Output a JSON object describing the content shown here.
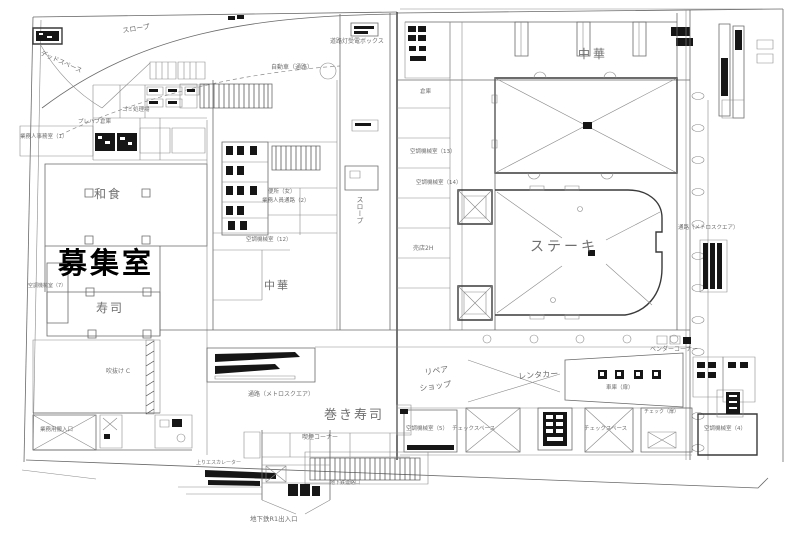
{
  "page": {
    "title": "建物平面図（1階フロアプラン）",
    "background": "#ffffff"
  },
  "colors": {
    "wall": "#5a5a5a",
    "wall_dark": "#1a1a1a",
    "label_text": "#6f6f6f",
    "highlight_text": "#000000"
  },
  "highlight": {
    "room": "募集室"
  },
  "labels": [
    {
      "name": "slope-top-label",
      "text": "スロープ",
      "x": 122,
      "y": 28,
      "size": 7,
      "rot": -9
    },
    {
      "name": "dead-space-label",
      "text": "デッドスペース",
      "x": 42,
      "y": 50,
      "size": 6.5,
      "rot": 24
    },
    {
      "name": "car-corridor-label",
      "text": "自動車（通路）",
      "x": 271,
      "y": 65,
      "size": 6
    },
    {
      "name": "street-light-box-label",
      "text": "道路灯受電ボックス",
      "x": 330,
      "y": 39,
      "size": 6
    },
    {
      "name": "chuka-top-label",
      "text": "中華",
      "x": 578,
      "y": 48,
      "size": 12,
      "ls": 3
    },
    {
      "name": "washoku-label",
      "text": "和食",
      "x": 94,
      "y": 188,
      "size": 12,
      "ls": 2
    },
    {
      "name": "boshushitsu-label",
      "text": "募集室",
      "x": 58,
      "y": 249,
      "size": 29,
      "ls": 3,
      "sharp": true
    },
    {
      "name": "sushi-label",
      "text": "寿司",
      "x": 96,
      "y": 302,
      "size": 12,
      "ls": 2
    },
    {
      "name": "chuka-center-label",
      "text": "中華",
      "x": 264,
      "y": 280,
      "size": 11,
      "ls": 2
    },
    {
      "name": "slope-center-label",
      "text": "スロープ",
      "x": 356,
      "y": 196,
      "size": 7,
      "vert": true
    },
    {
      "name": "steak-label",
      "text": "ステーキ",
      "x": 530,
      "y": 240,
      "size": 14,
      "ls": 3
    },
    {
      "name": "baiten-2h-label",
      "text": "売店2H",
      "x": 413,
      "y": 246,
      "size": 6
    },
    {
      "name": "tsuro-right-label",
      "text": "通路（メトロスクエア）",
      "x": 678,
      "y": 226,
      "size": 5.5
    },
    {
      "name": "tsuro-bottom-label",
      "text": "通路（メトロスクエア）",
      "x": 248,
      "y": 392,
      "size": 6
    },
    {
      "name": "makizushi-label",
      "text": "巻き寿司",
      "x": 324,
      "y": 409,
      "size": 13,
      "ls": 2
    },
    {
      "name": "repair-shop-label-1",
      "text": "リペア",
      "x": 424,
      "y": 369,
      "size": 8,
      "rot": -8
    },
    {
      "name": "repair-shop-label-2",
      "text": "ショップ",
      "x": 419,
      "y": 385,
      "size": 8,
      "rot": -8
    },
    {
      "name": "rentacar-label",
      "text": "レンタカー",
      "x": 518,
      "y": 373,
      "size": 8,
      "rot": -4
    },
    {
      "name": "vendor-corner-label",
      "text": "ベンダーコーナー",
      "x": 650,
      "y": 347,
      "size": 6
    },
    {
      "name": "ac-room-5-label",
      "text": "空調機械室（5）",
      "x": 406,
      "y": 427,
      "size": 5.5
    },
    {
      "name": "check-space-1-label",
      "text": "チェックスペース",
      "x": 452,
      "y": 427,
      "size": 5.5
    },
    {
      "name": "check-space-2-label",
      "text": "チェックスペース",
      "x": 584,
      "y": 427,
      "size": 5.5
    },
    {
      "name": "check-door-label",
      "text": "チェック（扉）",
      "x": 644,
      "y": 410,
      "size": 5
    },
    {
      "name": "ac-room-4-label",
      "text": "空調機械室（4）",
      "x": 704,
      "y": 427,
      "size": 5.5
    },
    {
      "name": "subway-entrance-label",
      "text": "地下鉄R1出入口",
      "x": 250,
      "y": 516,
      "size": 6.5
    },
    {
      "name": "smoking-corner-label",
      "text": "喫煙コーナー",
      "x": 302,
      "y": 435,
      "size": 6
    },
    {
      "name": "toilet-women-label",
      "text": "便所（女）",
      "x": 268,
      "y": 190,
      "size": 5.5
    },
    {
      "name": "staff-corridor-2-label",
      "text": "業務人員通路（2）",
      "x": 262,
      "y": 199,
      "size": 5.5
    },
    {
      "name": "ac-room-12-label",
      "text": "空調機械室（12）",
      "x": 246,
      "y": 238,
      "size": 5.5
    },
    {
      "name": "ac-room-13-label",
      "text": "空調機械室（13）",
      "x": 410,
      "y": 150,
      "size": 5.5
    },
    {
      "name": "ac-room-14-label",
      "text": "空調機械室（14）",
      "x": 416,
      "y": 181,
      "size": 5.5
    },
    {
      "name": "ac-room-7-label",
      "text": "空調機械室（7）",
      "x": 28,
      "y": 284,
      "size": 5
    },
    {
      "name": "gomi-label",
      "text": "ゴミ処理場",
      "x": 122,
      "y": 108,
      "size": 5.5
    },
    {
      "name": "prefab-label",
      "text": "プレハブ倉庫",
      "x": 78,
      "y": 120,
      "size": 5.5
    },
    {
      "name": "staff-office-1-label",
      "text": "業務人事務室（1）",
      "x": 20,
      "y": 135,
      "size": 5.5
    },
    {
      "name": "souko-label",
      "text": "倉庫",
      "x": 420,
      "y": 90,
      "size": 5.5
    },
    {
      "name": "shako-door-label",
      "text": "車庫（扉）",
      "x": 606,
      "y": 386,
      "size": 5.5
    },
    {
      "name": "up-escalator-label",
      "text": "上りエスカレーター",
      "x": 196,
      "y": 461,
      "size": 5
    },
    {
      "name": "subway-link-label",
      "text": "地下鉄連絡口",
      "x": 330,
      "y": 481,
      "size": 5
    },
    {
      "name": "service-entrance-label",
      "text": "業務用搬入口",
      "x": 40,
      "y": 428,
      "size": 5.5
    },
    {
      "name": "fukinuke-label",
      "text": "吹抜け C",
      "x": 106,
      "y": 369,
      "size": 6
    }
  ]
}
